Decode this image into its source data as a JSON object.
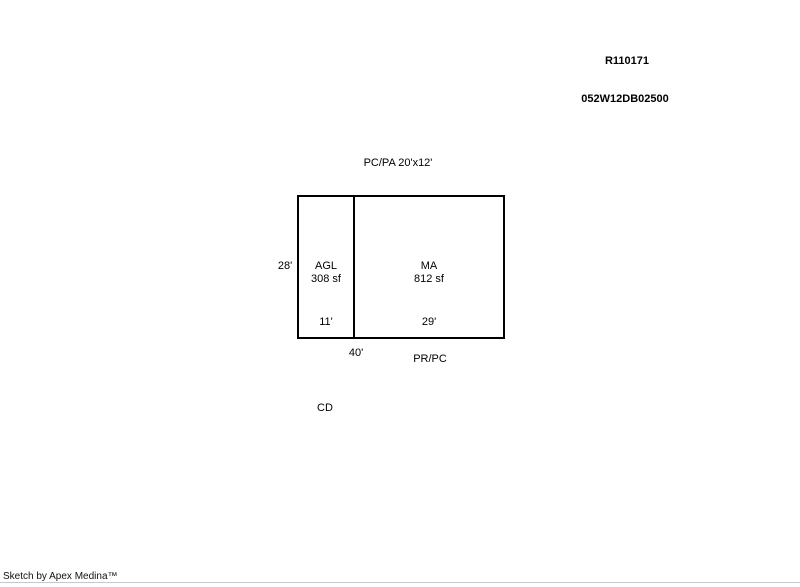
{
  "page": {
    "background": "#ffffff",
    "line_color": "#000000",
    "footer_rule_color": "#c8c8c8"
  },
  "header": {
    "record_id": "R110171",
    "parcel_id": "052W12DB02500"
  },
  "sketch": {
    "top_label": "PC/PA 20'x12'",
    "left_dimension": "28'",
    "bottom_dimension": "40'",
    "bottom_right_label": "PR/PC",
    "detached_label": "CD",
    "areas": [
      {
        "code": "AGL",
        "size": "308 sf",
        "width_label": "11'"
      },
      {
        "code": "MA",
        "size": "812 sf",
        "width_label": "29'"
      }
    ]
  },
  "footer": {
    "credit": "Sketch by Apex Medina™"
  }
}
